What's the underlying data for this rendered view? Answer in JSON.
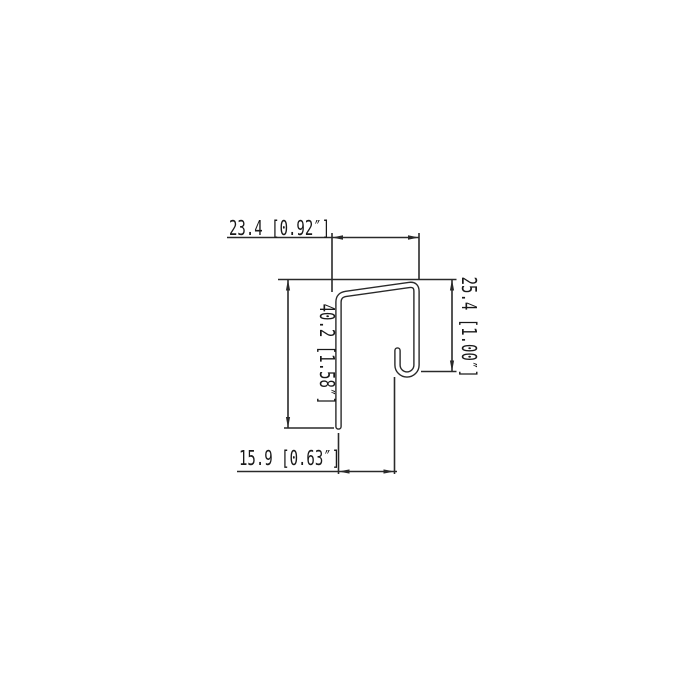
{
  "drawing": {
    "kind": "profile-cross-section-dimension-drawing",
    "background": "#ffffff",
    "colors": {
      "line": "#2a2a2a",
      "text": "#1a1a1a",
      "profile_fill": "#ffffff"
    },
    "labels": {
      "top_width": "23.4 [0.92″]",
      "left_height": "40.2 [1.58″]",
      "right_height": "25.4 [1.00″]",
      "bottom_width": "15.9 [0.63″]"
    },
    "dimensions": {
      "top_width": {
        "mm": 23.4,
        "inches": "0.92″"
      },
      "left_height": {
        "mm": 40.2,
        "inches": "1.58″"
      },
      "right_height": {
        "mm": 25.4,
        "inches": "1.00″"
      },
      "bottom_width": {
        "mm": 15.9,
        "inches": "0.63″"
      }
    }
  }
}
